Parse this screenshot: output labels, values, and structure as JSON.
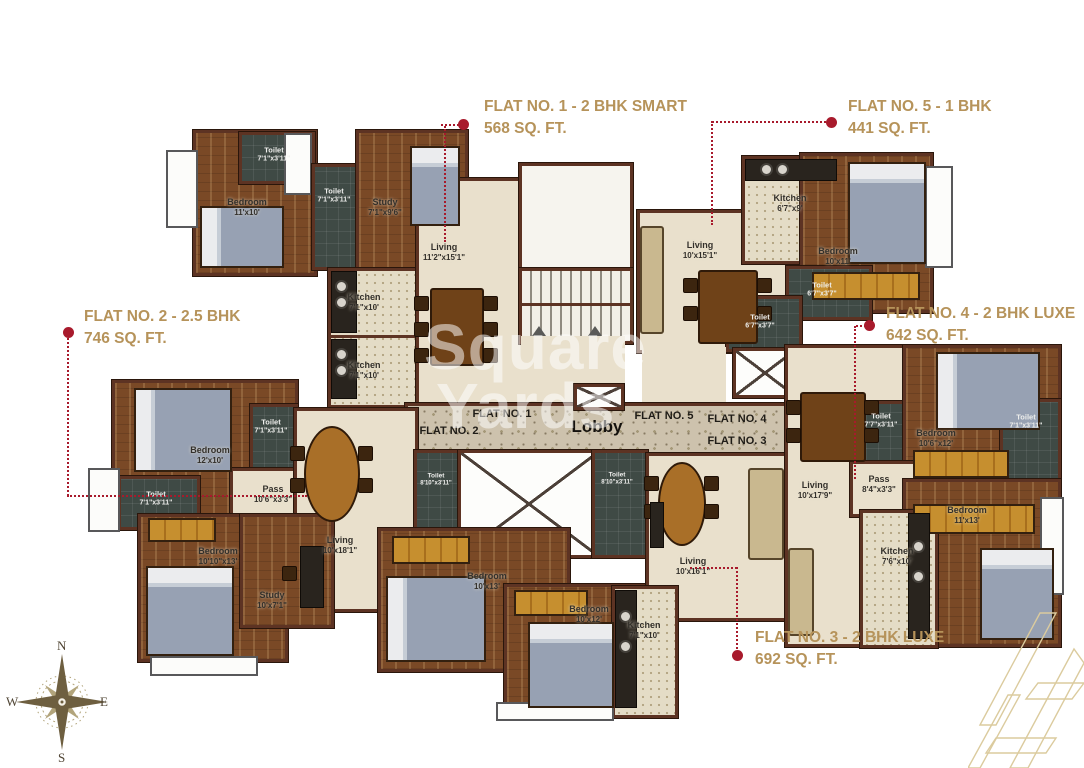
{
  "callouts": {
    "flat1": {
      "title": "FLAT NO. 1 - 2 BHK SMART",
      "area": "568 SQ. FT."
    },
    "flat2": {
      "title": "FLAT NO. 2 - 2.5 BHK",
      "area": "746 SQ. FT."
    },
    "flat3": {
      "title": "FLAT NO. 3 - 2 BHK LUXE",
      "area": "692 SQ. FT."
    },
    "flat4": {
      "title": "FLAT NO. 4 - 2 BHK LUXE",
      "area": "642 SQ. FT."
    },
    "flat5": {
      "title": "FLAT NO. 5 - 1 BHK",
      "area": "441 SQ. FT."
    }
  },
  "lobby": {
    "label": "Lobby",
    "tags": {
      "f1": "FLAT NO. 1",
      "f2": "FLAT NO. 2",
      "f3": "FLAT NO. 3",
      "f4": "FLAT NO. 4",
      "f5": "FLAT NO. 5"
    }
  },
  "rooms": {
    "f1_toilet_a": {
      "name": "Toilet",
      "dim": "7'1\"x3'11\""
    },
    "f1_bedroom": {
      "name": "Bedroom",
      "dim": "11'x10'"
    },
    "f1_toilet_b": {
      "name": "Toilet",
      "dim": "7'1\"x3'11\""
    },
    "f1_study": {
      "name": "Study",
      "dim": "7'1\"x9'6\""
    },
    "f1_living": {
      "name": "Living",
      "dim": "11'2\"x15'1\""
    },
    "f1_kitchen": {
      "name": "Kitchen",
      "dim": "7'1\"x10'"
    },
    "f2_kitchen": {
      "name": "Kitchen",
      "dim": "7'1\"x10'"
    },
    "f2_bedroom_a": {
      "name": "Bedroom",
      "dim": "12'x10'"
    },
    "f2_toilet_a": {
      "name": "Toilet",
      "dim": "7'1\"x3'11\""
    },
    "f2_toilet_b": {
      "name": "Toilet",
      "dim": "7'1\"x3'11\""
    },
    "f2_pass": {
      "name": "Pass",
      "dim": "10'6\"x3'3\""
    },
    "f2_living": {
      "name": "Living",
      "dim": "10'x18'1\""
    },
    "f2_bedroom_b": {
      "name": "Bedroom",
      "dim": "10'10\"x13'"
    },
    "f2_study": {
      "name": "Study",
      "dim": "10'x7'1\""
    },
    "f5_kitchen": {
      "name": "Kitchen",
      "dim": "6'7\"x9'"
    },
    "f5_living": {
      "name": "Living",
      "dim": "10'x15'1\""
    },
    "f5_bedroom": {
      "name": "Bedroom",
      "dim": "10'x11'"
    },
    "f5_toilet_a": {
      "name": "Toilet",
      "dim": "6'7\"x3'7\""
    },
    "f5_toilet_b": {
      "name": "Toilet",
      "dim": "6'7\"x3'7\""
    },
    "f4_toilet_a": {
      "name": "Toilet",
      "dim": "7'7\"x3'11\""
    },
    "f4_bedroom_a": {
      "name": "Bedroom",
      "dim": "10'6\"x12'"
    },
    "f4_toilet_b": {
      "name": "Toilet",
      "dim": "7'1\"x3'11\""
    },
    "f4_living": {
      "name": "Living",
      "dim": "10'x17'9\""
    },
    "f4_pass": {
      "name": "Pass",
      "dim": "8'4\"x3'3\""
    },
    "f4_bedroom_b": {
      "name": "Bedroom",
      "dim": "11'x13'"
    },
    "f4_kitchen": {
      "name": "Kitchen",
      "dim": "7'6\"x10'"
    },
    "f3_toilet_a": {
      "name": "Toilet",
      "dim": "8'10\"x3'11\""
    },
    "f3_toilet_b": {
      "name": "Toilet",
      "dim": "8'10\"x3'11\""
    },
    "f3_bedroom_a": {
      "name": "Bedroom",
      "dim": "10'x13'"
    },
    "f3_bedroom_b": {
      "name": "Bedroom",
      "dim": "10'x12'"
    },
    "f3_living": {
      "name": "Living",
      "dim": "10'x16'1\""
    },
    "f3_kitchen": {
      "name": "Kitchen",
      "dim": "7'1\"x10'"
    }
  },
  "compass": {
    "n": "N",
    "e": "E",
    "s": "S",
    "w": "W"
  },
  "watermark": {
    "line1": "Square",
    "line2": "Yards"
  },
  "colors": {
    "accent_gold": "#b6935a",
    "marker_red": "#a81a2c",
    "wall_brown": "#5d3323"
  }
}
